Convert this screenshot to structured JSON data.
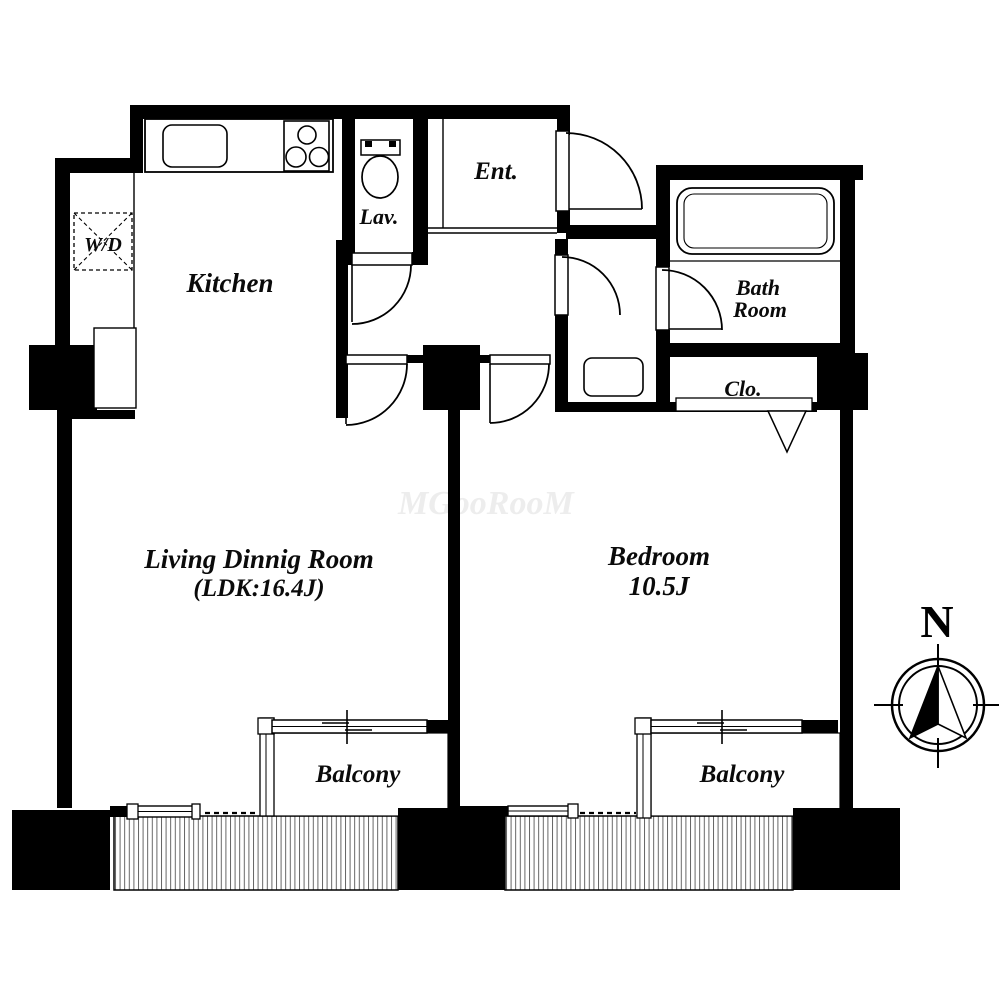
{
  "floor_plan": {
    "rooms": {
      "kitchen": {
        "label": "Kitchen"
      },
      "washer_dryer": {
        "label": "W/D"
      },
      "lavatory": {
        "label": "Lav."
      },
      "entrance": {
        "label": "Ent."
      },
      "bathroom": {
        "label_line1": "Bath",
        "label_line2": "Room"
      },
      "closet": {
        "label": "Clo."
      },
      "living_dining": {
        "label_line1": "Living Dinnig Room",
        "label_line2": "(LDK:16.4J)"
      },
      "bedroom": {
        "label_line1": "Bedroom",
        "label_line2": "10.5J"
      },
      "balcony_left": {
        "label": "Balcony"
      },
      "balcony_right": {
        "label": "Balcony"
      }
    },
    "compass": {
      "north_label": "N"
    },
    "watermark": "MGooRooM",
    "fixtures": [
      "kitchen-sink-icon",
      "stove-burners-icon",
      "toilet-icon",
      "bathtub-icon",
      "washing-machine-icon",
      "closet-shelf-icon",
      "hanger-pipe-icon"
    ],
    "colors": {
      "wall": "#000000",
      "background": "#ffffff",
      "watermark": "#ededed"
    }
  }
}
